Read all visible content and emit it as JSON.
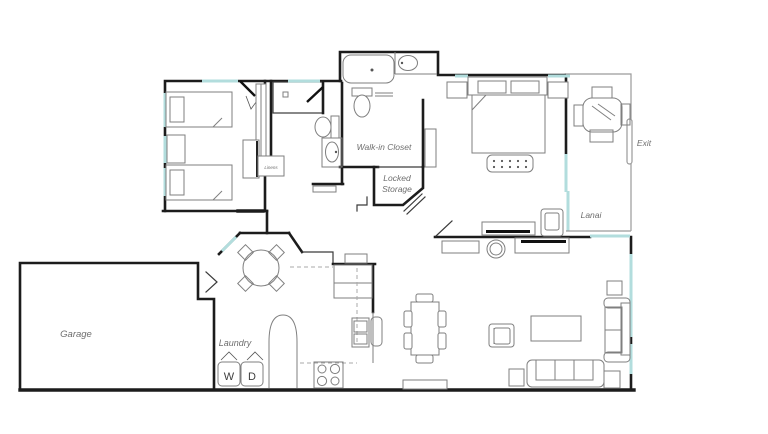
{
  "floorplan": {
    "title": "house-floor-plan",
    "labels": {
      "garage": "Garage",
      "laundry": "Laundry",
      "washer": "W",
      "dryer": "D",
      "walk_in_closet": "Walk-in Closet",
      "locked_storage_line1": "Locked",
      "locked_storage_line2": "Storage",
      "lanai": "Lanai",
      "exit": "Exit",
      "linens": "Linens"
    },
    "colors": {
      "wall": "#1c1c1c",
      "furniture": "#7f7f7f",
      "window": "#b2dddd",
      "label": "#6e6e6e"
    }
  }
}
